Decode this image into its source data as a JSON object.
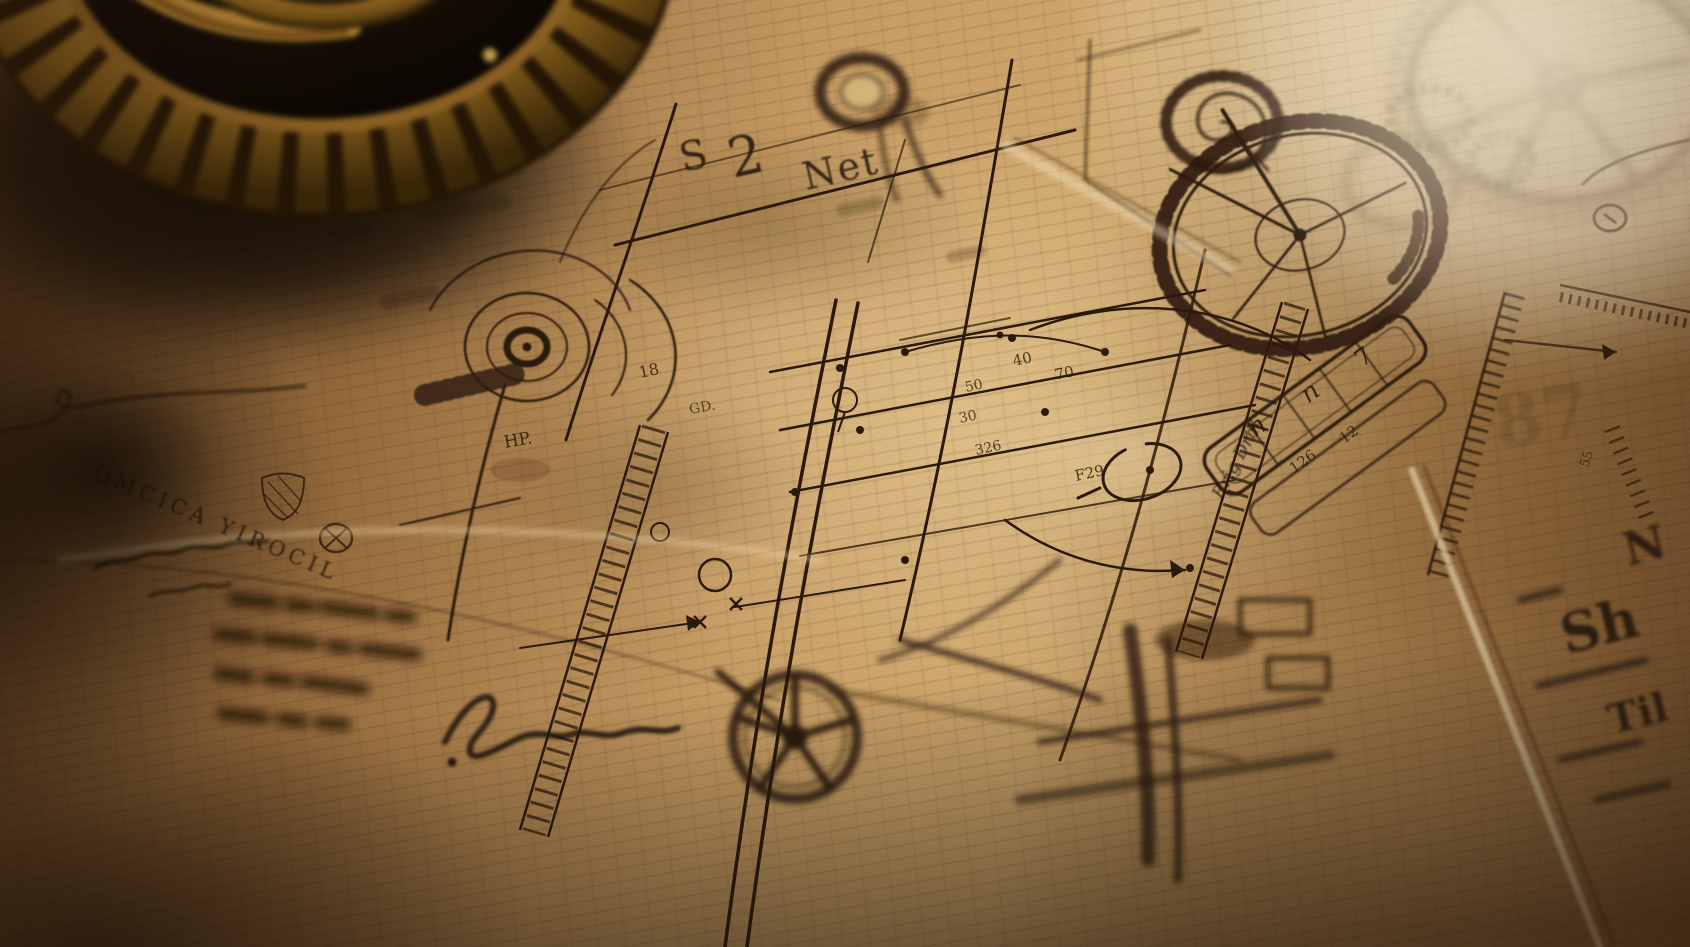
{
  "scene": {
    "description": "close-up photo of an aged parchment blueprint of clockwork machinery with a real brass gear resting on it, strong light glare upper-right, deep shadow lower-left",
    "palette": {
      "ink": "#2b1a0b",
      "parchment_light": "#ecd3a4",
      "parchment_mid": "#c59b63",
      "parchment_dark": "#6e4d2c",
      "deep_shadow": "#1a0f05",
      "brass": "#c8943a",
      "brass_highlight": "#f3da8e",
      "glare": "#fdf2d6"
    }
  },
  "inscriptions": {
    "title_s": "S",
    "title_2": "2",
    "title_net": "Net",
    "left_caption": "OMCICA YIROCIL",
    "vertical_script": "Brig Drill",
    "stamp": "GD.",
    "dial_number": "18",
    "dial_label": "HP.",
    "grid_number_1": "40",
    "grid_number_2": "70",
    "grid_number_3": "50",
    "grid_number_4": "30",
    "grid_number_5": "326",
    "grid_number_6": "F29",
    "bar_letter_1": "n",
    "bar_letter_2": "n",
    "bar_letter_3": "7",
    "bar_number_1": "12",
    "bar_number_2": "126",
    "edge_letter_1": "N",
    "edge_letter_2": "Sh",
    "edge_letter_3": "Til",
    "watermark": "87",
    "ruler_number": "55"
  }
}
